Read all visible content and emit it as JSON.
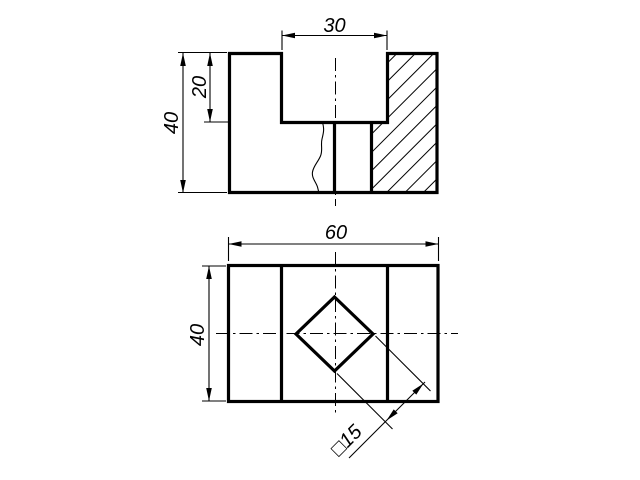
{
  "drawing": {
    "paper_color": "#ffffff",
    "ink_color": "#000000",
    "front_view": {
      "slot_width_label": "30",
      "slot_depth_label": "20",
      "height_label": "40"
    },
    "plan_view": {
      "width_label": "60",
      "depth_label": "40",
      "square_hole_label": "□15"
    }
  }
}
